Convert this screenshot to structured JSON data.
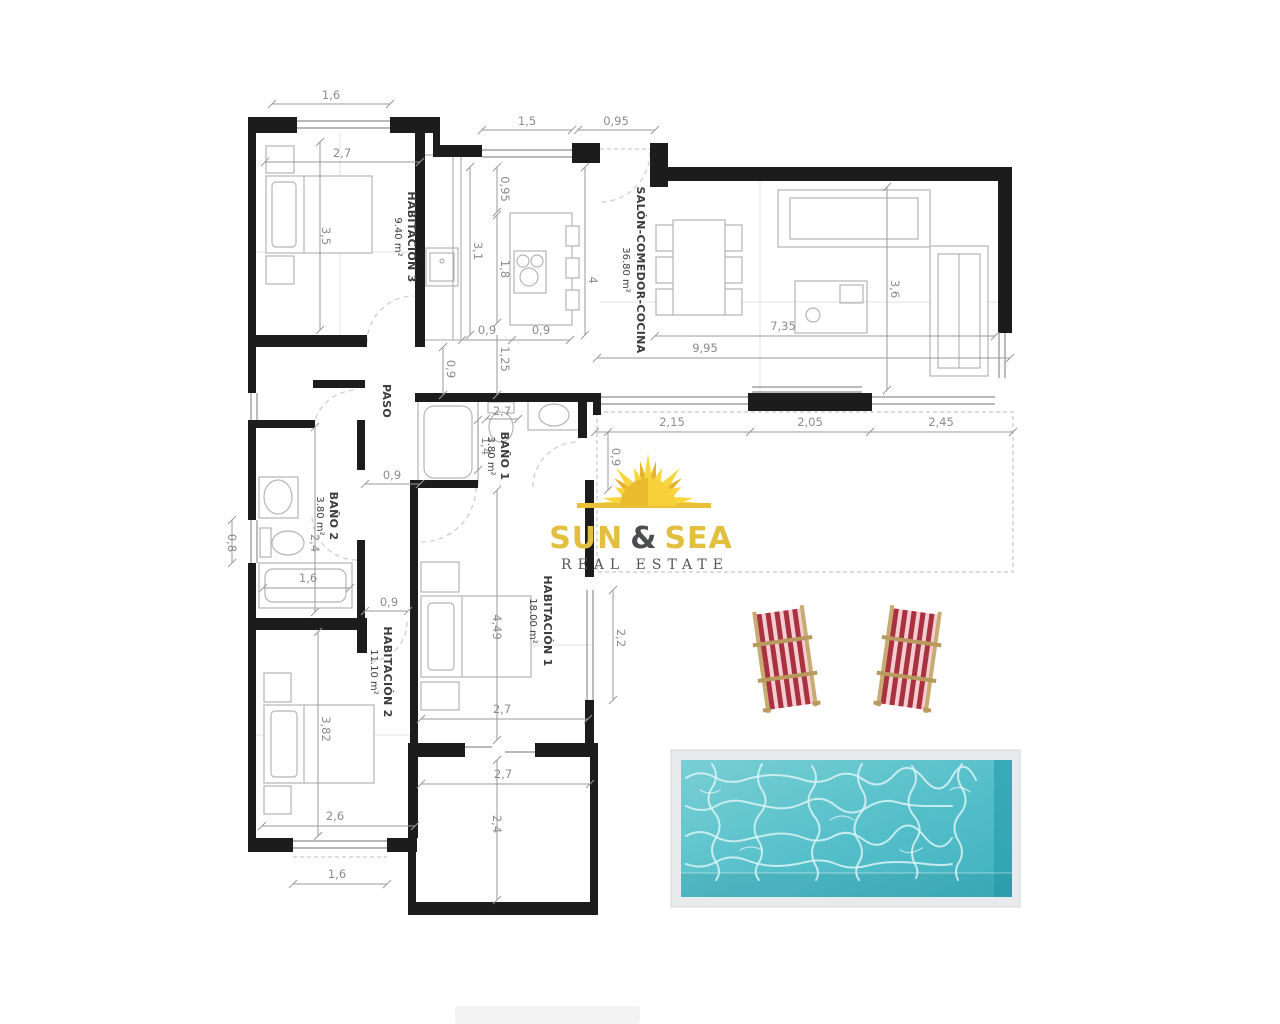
{
  "brand": {
    "sun": "SUN",
    "amp": "&",
    "sea": "SEA",
    "tagline": "REAL ESTATE"
  },
  "rooms": [
    {
      "name": "HABITACIÓN 3",
      "area": "9.40 m²"
    },
    {
      "name": "SALÓN-COMEDOR-COCINA",
      "area": "36.80 m²"
    },
    {
      "name": "PASO",
      "area": ""
    },
    {
      "name": "BAÑO 1",
      "area": "3.80 m²"
    },
    {
      "name": "BAÑO 2",
      "area": "3.80 m²"
    },
    {
      "name": "HABITACIÓN 1",
      "area": "18.00 m²"
    },
    {
      "name": "HABITACIÓN 2",
      "area": "11.10 m²"
    }
  ],
  "dims": [
    "1,6",
    "2,7",
    "3,5",
    "1,5",
    "0,95",
    "0,95",
    "3,1",
    "1,8",
    "4",
    "3,6",
    "7,35",
    "9,95",
    "0,9",
    "0,9",
    "1,25",
    "0,9",
    "2,15",
    "2,05",
    "2,45",
    "0,9",
    "0,9",
    "2,7",
    "1,4",
    "0,8",
    "2,4",
    "1,6",
    "4,49",
    "2,2",
    "2,7",
    "0,9",
    "3,82",
    "2,6",
    "1,6",
    "2,7",
    "2,4"
  ],
  "icons": [
    "sun-icon",
    "pool",
    "deck-chair",
    "bed",
    "bathtub",
    "toilet",
    "sink",
    "stove",
    "dining-table",
    "sofa"
  ],
  "colors": {
    "wall": "#1c1c1c",
    "furniture_line": "#b5b5b5",
    "dimension_line": "#9a9a9a",
    "dimension_text": "#8c8c8c",
    "room_text": "#3d3d3d",
    "door_arc": "#cfcfcf",
    "pool_water_light": "#74ccd2",
    "pool_water_dark": "#3fb1be",
    "pool_frame": "#e7ebeb",
    "pool_ripple": "#d8f3f6",
    "chair_stripe_dark": "#a93241",
    "chair_stripe_light": "#f4ccd1",
    "chair_wood": "#c7ab72",
    "logo_gold": "#e2bf3e",
    "logo_dark": "#4b4d50",
    "sun_yellow": "#f8d73e",
    "sun_gold": "#e5b32d"
  }
}
